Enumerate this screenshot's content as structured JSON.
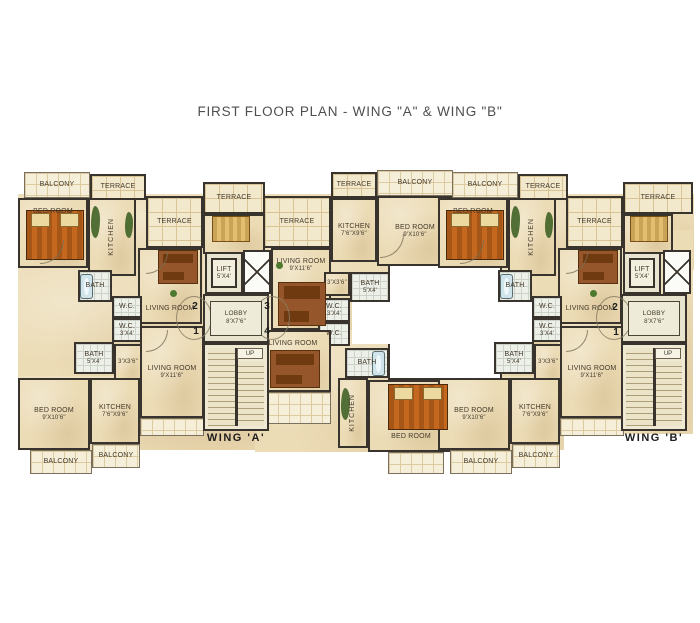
{
  "title": "FIRST FLOOR PLAN - WING \"A\" & WING \"B\"",
  "wing_a_label": "WING 'A'",
  "wing_b_label": "WING 'B'",
  "up_label": "UP",
  "colors": {
    "wall": "#38332c",
    "floor": "#ecdcb6",
    "terrace_tile": "#f2e8cc",
    "bath_tile": "#edefe9",
    "courtyard": "#ffffff",
    "bed": "#c4671f",
    "plant_green": "#3f6226",
    "title_text": "#4e4e4e"
  },
  "plan": {
    "slabs": [
      {
        "x": 18,
        "y": 194,
        "w": 436,
        "h": 76
      },
      {
        "x": 18,
        "y": 268,
        "w": 188,
        "h": 112
      },
      {
        "x": 203,
        "y": 232,
        "w": 68,
        "h": 200
      },
      {
        "x": 255,
        "y": 248,
        "w": 135,
        "h": 146
      },
      {
        "x": 18,
        "y": 376,
        "w": 254,
        "h": 74
      },
      {
        "x": 255,
        "y": 330,
        "w": 199,
        "h": 122
      },
      {
        "x": 438,
        "y": 194,
        "w": 256,
        "h": 76
      },
      {
        "x": 438,
        "y": 268,
        "w": 126,
        "h": 110
      },
      {
        "x": 558,
        "y": 248,
        "w": 68,
        "h": 170
      },
      {
        "x": 621,
        "y": 230,
        "w": 72,
        "h": 204
      },
      {
        "x": 438,
        "y": 376,
        "w": 126,
        "h": 74
      }
    ],
    "rooms": [
      {
        "n": "courtyard",
        "t": "court",
        "x": 388,
        "y": 264,
        "w": 114,
        "h": 116
      },
      {
        "n": "courtyard-notch-left",
        "t": "courtn",
        "x": 352,
        "y": 302,
        "w": 38,
        "h": 42
      },
      {
        "n": "courtyard-notch-right",
        "t": "courtn",
        "x": 500,
        "y": 302,
        "w": 34,
        "h": 40
      },
      {
        "n": "balcony-a2-top",
        "t": "balcony",
        "x": 24,
        "y": 172,
        "w": 66,
        "h": 26,
        "l": "BALCONY"
      },
      {
        "n": "terrace-a2-top",
        "t": "terrace",
        "x": 90,
        "y": 174,
        "w": 56,
        "h": 26,
        "l": "TERRACE"
      },
      {
        "n": "bedroom-a2",
        "t": "room",
        "x": 18,
        "y": 198,
        "w": 70,
        "h": 70,
        "l": "BED ROOM",
        "p": "top"
      },
      {
        "n": "kitchen-a2",
        "t": "room",
        "x": 88,
        "y": 198,
        "w": 48,
        "h": 78,
        "l": "KITCHEN",
        "v": 1
      },
      {
        "n": "terrace-a2-big",
        "t": "terrace",
        "x": 146,
        "y": 196,
        "w": 57,
        "h": 52,
        "l": "TERRACE"
      },
      {
        "n": "terrace-a-core",
        "t": "terrace",
        "x": 203,
        "y": 182,
        "w": 62,
        "h": 32,
        "l": "TERRACE"
      },
      {
        "n": "room-a-core",
        "t": "room",
        "x": 203,
        "y": 214,
        "w": 62,
        "h": 40
      },
      {
        "n": "terrace-a3-big",
        "t": "terrace",
        "x": 263,
        "y": 196,
        "w": 68,
        "h": 52,
        "l": "TERRACE"
      },
      {
        "n": "terrace-a3-top",
        "t": "terrace",
        "x": 331,
        "y": 172,
        "w": 46,
        "h": 26,
        "l": "TERRACE"
      },
      {
        "n": "balcony-a4-top",
        "t": "balcony",
        "x": 377,
        "y": 170,
        "w": 76,
        "h": 26,
        "l": "BALCONY"
      },
      {
        "n": "kitchen-a3",
        "t": "room",
        "x": 331,
        "y": 198,
        "w": 46,
        "h": 64,
        "l": "KITCHEN",
        "d": "7'6\"X9'6\""
      },
      {
        "n": "bedroom-a3",
        "t": "room",
        "x": 377,
        "y": 196,
        "w": 76,
        "h": 70,
        "l": "BED ROOM",
        "d": "9'X10'6\""
      },
      {
        "n": "livingroom-a2",
        "t": "room",
        "x": 138,
        "y": 248,
        "w": 64,
        "h": 76,
        "l": "LIVING ROOM",
        "p": "bot"
      },
      {
        "n": "bath-a2",
        "t": "bath",
        "x": 78,
        "y": 270,
        "w": 34,
        "h": 32,
        "l": "BATH"
      },
      {
        "n": "wc-a2",
        "t": "bath",
        "x": 112,
        "y": 296,
        "w": 30,
        "h": 22,
        "l": "W.C."
      },
      {
        "n": "wc-a1",
        "t": "bath",
        "x": 112,
        "y": 318,
        "w": 30,
        "h": 24,
        "l": "W.C.",
        "d": "3'X4'"
      },
      {
        "n": "bath-a1",
        "t": "bath",
        "x": 74,
        "y": 342,
        "w": 40,
        "h": 32,
        "l": "BATH",
        "d": "5'X4'"
      },
      {
        "n": "passage-a1",
        "t": "room",
        "x": 114,
        "y": 344,
        "w": 28,
        "h": 38,
        "l": "3'X3'6\"",
        "s": 1
      },
      {
        "n": "livingroom-a1",
        "t": "room",
        "x": 140,
        "y": 326,
        "w": 64,
        "h": 92,
        "l": "LIVING ROOM",
        "d": "9'X11'6\""
      },
      {
        "n": "bedroom-a1",
        "t": "room",
        "x": 18,
        "y": 378,
        "w": 72,
        "h": 72,
        "l": "BED ROOM",
        "d": "9'X10'6\""
      },
      {
        "n": "kitchen-a1",
        "t": "room",
        "x": 90,
        "y": 378,
        "w": 50,
        "h": 66,
        "l": "KITCHEN",
        "d": "7'6\"X9'6\""
      },
      {
        "n": "balcony-a1",
        "t": "balcony",
        "x": 30,
        "y": 450,
        "w": 62,
        "h": 24,
        "l": "BALCONY"
      },
      {
        "n": "balcony-a1k",
        "t": "balcony",
        "x": 92,
        "y": 444,
        "w": 48,
        "h": 24,
        "l": "BALCONY"
      },
      {
        "n": "tile-a1",
        "t": "balcony",
        "x": 140,
        "y": 418,
        "w": 64,
        "h": 18
      },
      {
        "n": "livingroom-a3",
        "t": "room",
        "x": 271,
        "y": 248,
        "w": 60,
        "h": 82,
        "l": "LIVING ROOM",
        "d": "9'X11'6\"",
        "p": "top"
      },
      {
        "n": "passage-a3",
        "t": "room",
        "x": 324,
        "y": 272,
        "w": 26,
        "h": 24,
        "l": "3'X3'6\"",
        "s": 1
      },
      {
        "n": "bath-a3",
        "t": "bath",
        "x": 350,
        "y": 272,
        "w": 40,
        "h": 30,
        "l": "BATH",
        "d": "5'X4'"
      },
      {
        "n": "wc-a3",
        "t": "bath",
        "x": 318,
        "y": 298,
        "w": 32,
        "h": 24,
        "l": "W.C.",
        "d": "3'X4'"
      },
      {
        "n": "wc-a4",
        "t": "bath",
        "x": 318,
        "y": 322,
        "w": 32,
        "h": 24,
        "l": "W.C."
      },
      {
        "n": "livingroom-a4",
        "t": "room",
        "x": 255,
        "y": 330,
        "w": 76,
        "h": 62,
        "l": "LIVING ROOM",
        "p": "top"
      },
      {
        "n": "terrace-a4",
        "t": "balcony",
        "x": 255,
        "y": 392,
        "w": 76,
        "h": 32
      },
      {
        "n": "kitchen-a4",
        "t": "room",
        "x": 338,
        "y": 378,
        "w": 30,
        "h": 70,
        "l": "KITCHEN",
        "v": 1
      },
      {
        "n": "bath-a4",
        "t": "bath",
        "x": 345,
        "y": 348,
        "w": 44,
        "h": 30,
        "l": "BATH"
      },
      {
        "n": "bedroom-a4",
        "t": "room",
        "x": 368,
        "y": 380,
        "w": 86,
        "h": 72,
        "l": "BED ROOM",
        "p": "bot"
      },
      {
        "n": "balcony-a4",
        "t": "balcony",
        "x": 388,
        "y": 452,
        "w": 56,
        "h": 22
      },
      {
        "n": "lift-a",
        "t": "lift",
        "x": 205,
        "y": 252,
        "w": 38,
        "h": 42,
        "l": "LIFT",
        "d": "5'X4'"
      },
      {
        "n": "shaft-a",
        "t": "xbox",
        "x": 243,
        "y": 250,
        "w": 28,
        "h": 44
      },
      {
        "n": "lobby-a",
        "t": "lobby",
        "x": 203,
        "y": 294,
        "w": 66,
        "h": 49,
        "l": "LOBBY",
        "d": "8'X7'6\""
      },
      {
        "n": "stair-a",
        "t": "stair",
        "x": 203,
        "y": 343,
        "w": 66,
        "h": 88
      },
      {
        "n": "balcony-b2-top",
        "t": "balcony",
        "x": 452,
        "y": 172,
        "w": 66,
        "h": 26,
        "l": "BALCONY"
      },
      {
        "n": "terrace-b2-top",
        "t": "terrace",
        "x": 518,
        "y": 174,
        "w": 50,
        "h": 26,
        "l": "TERRACE"
      },
      {
        "n": "bedroom-b2",
        "t": "room",
        "x": 438,
        "y": 198,
        "w": 70,
        "h": 70,
        "l": "BED ROOM",
        "p": "top"
      },
      {
        "n": "kitchen-b2",
        "t": "room",
        "x": 508,
        "y": 198,
        "w": 48,
        "h": 78,
        "l": "KITCHEN",
        "v": 1
      },
      {
        "n": "terrace-b2-big",
        "t": "terrace",
        "x": 566,
        "y": 196,
        "w": 57,
        "h": 52,
        "l": "TERRACE"
      },
      {
        "n": "terrace-b-core",
        "t": "terrace",
        "x": 623,
        "y": 182,
        "w": 70,
        "h": 32,
        "l": "TERRACE"
      },
      {
        "n": "room-b-core",
        "t": "room",
        "x": 623,
        "y": 214,
        "w": 50,
        "h": 40
      },
      {
        "n": "livingroom-b2",
        "t": "room",
        "x": 558,
        "y": 248,
        "w": 64,
        "h": 76,
        "l": "LIVING ROOM",
        "p": "bot"
      },
      {
        "n": "bath-b2",
        "t": "bath",
        "x": 498,
        "y": 270,
        "w": 34,
        "h": 32,
        "l": "BATH"
      },
      {
        "n": "wc-b2",
        "t": "bath",
        "x": 532,
        "y": 296,
        "w": 30,
        "h": 22,
        "l": "W.C."
      },
      {
        "n": "wc-b1",
        "t": "bath",
        "x": 532,
        "y": 318,
        "w": 30,
        "h": 24,
        "l": "W.C.",
        "d": "3'X4'"
      },
      {
        "n": "bath-b1",
        "t": "bath",
        "x": 494,
        "y": 342,
        "w": 40,
        "h": 32,
        "l": "BATH",
        "d": "5'X4'"
      },
      {
        "n": "passage-b1",
        "t": "room",
        "x": 534,
        "y": 344,
        "w": 28,
        "h": 38,
        "l": "3'X3'6\"",
        "s": 1
      },
      {
        "n": "livingroom-b1",
        "t": "room",
        "x": 560,
        "y": 326,
        "w": 64,
        "h": 92,
        "l": "LIVING ROOM",
        "d": "9'X11'6\""
      },
      {
        "n": "bedroom-b1",
        "t": "room",
        "x": 438,
        "y": 378,
        "w": 72,
        "h": 72,
        "l": "BED ROOM",
        "d": "9'X10'6\""
      },
      {
        "n": "kitchen-b1",
        "t": "room",
        "x": 510,
        "y": 378,
        "w": 50,
        "h": 66,
        "l": "KITCHEN",
        "d": "7'6\"X9'6\""
      },
      {
        "n": "balcony-b1",
        "t": "balcony",
        "x": 450,
        "y": 450,
        "w": 62,
        "h": 24,
        "l": "BALCONY"
      },
      {
        "n": "balcony-b1k",
        "t": "balcony",
        "x": 512,
        "y": 444,
        "w": 48,
        "h": 24,
        "l": "BALCONY"
      },
      {
        "n": "tile-b1",
        "t": "balcony",
        "x": 560,
        "y": 418,
        "w": 64,
        "h": 18
      },
      {
        "n": "lift-b",
        "t": "lift",
        "x": 623,
        "y": 252,
        "w": 38,
        "h": 42,
        "l": "LIFT",
        "d": "5'X4'"
      },
      {
        "n": "shaft-b",
        "t": "xbox",
        "x": 663,
        "y": 250,
        "w": 28,
        "h": 44
      },
      {
        "n": "lobby-b",
        "t": "lobby",
        "x": 621,
        "y": 294,
        "w": 66,
        "h": 49,
        "l": "LOBBY",
        "d": "8'X7'6\""
      },
      {
        "n": "stair-b",
        "t": "stair",
        "x": 621,
        "y": 343,
        "w": 66,
        "h": 88
      }
    ],
    "furniture": [
      {
        "k": "bed",
        "x": 26,
        "y": 210,
        "w": 58,
        "h": 50
      },
      {
        "k": "bed",
        "x": 446,
        "y": 210,
        "w": 58,
        "h": 50
      },
      {
        "k": "bed",
        "x": 388,
        "y": 384,
        "w": 60,
        "h": 46
      },
      {
        "k": "bedsm",
        "x": 212,
        "y": 216,
        "w": 38,
        "h": 26
      },
      {
        "k": "bedsm",
        "x": 630,
        "y": 216,
        "w": 38,
        "h": 26
      },
      {
        "k": "sofa",
        "x": 158,
        "y": 250,
        "w": 40,
        "h": 34
      },
      {
        "k": "sofa",
        "x": 278,
        "y": 282,
        "w": 48,
        "h": 44
      },
      {
        "k": "sofa",
        "x": 270,
        "y": 350,
        "w": 50,
        "h": 38
      },
      {
        "k": "sofa",
        "x": 578,
        "y": 250,
        "w": 40,
        "h": 34
      },
      {
        "k": "tub",
        "x": 80,
        "y": 274,
        "w": 13,
        "h": 25
      },
      {
        "k": "tub",
        "x": 500,
        "y": 274,
        "w": 13,
        "h": 25
      },
      {
        "k": "tub",
        "x": 372,
        "y": 351,
        "w": 13,
        "h": 25
      },
      {
        "k": "plant",
        "x": 91,
        "y": 206,
        "w": 9,
        "h": 32
      },
      {
        "k": "plant",
        "x": 125,
        "y": 212,
        "w": 8,
        "h": 26
      },
      {
        "k": "plant",
        "x": 511,
        "y": 206,
        "w": 9,
        "h": 32
      },
      {
        "k": "plant",
        "x": 545,
        "y": 212,
        "w": 8,
        "h": 26
      },
      {
        "k": "plant",
        "x": 341,
        "y": 388,
        "w": 9,
        "h": 32
      },
      {
        "k": "dot",
        "x": 170,
        "y": 290,
        "w": 7,
        "h": 7
      },
      {
        "k": "dot",
        "x": 590,
        "y": 290,
        "w": 7,
        "h": 7
      },
      {
        "k": "dot",
        "x": 276,
        "y": 262,
        "w": 7,
        "h": 7
      },
      {
        "k": "ell",
        "x": 176,
        "y": 296,
        "w": 36,
        "h": 44
      },
      {
        "k": "ell",
        "x": 254,
        "y": 296,
        "w": 36,
        "h": 44
      },
      {
        "k": "ell",
        "x": 596,
        "y": 296,
        "w": 36,
        "h": 44
      },
      {
        "k": "arc",
        "x": 146,
        "y": 252,
        "w": 22,
        "h": 22
      },
      {
        "k": "arc",
        "x": 566,
        "y": 252,
        "w": 22,
        "h": 22
      },
      {
        "k": "arc",
        "x": 380,
        "y": 234,
        "w": 24,
        "h": 24
      },
      {
        "k": "arc",
        "x": 146,
        "y": 330,
        "w": 22,
        "h": 22
      },
      {
        "k": "arc",
        "x": 566,
        "y": 330,
        "w": 22,
        "h": 22
      },
      {
        "k": "arc",
        "x": 40,
        "y": 240,
        "w": 24,
        "h": 24
      },
      {
        "k": "arc",
        "x": 460,
        "y": 240,
        "w": 24,
        "h": 24
      }
    ],
    "markers": [
      {
        "m": "2",
        "x": 188,
        "y": 300
      },
      {
        "m": "3",
        "x": 260,
        "y": 300
      },
      {
        "m": "1",
        "x": 189,
        "y": 325
      },
      {
        "m": "4",
        "x": 260,
        "y": 325
      },
      {
        "m": "2",
        "x": 608,
        "y": 301
      },
      {
        "m": "1",
        "x": 609,
        "y": 326
      }
    ]
  }
}
